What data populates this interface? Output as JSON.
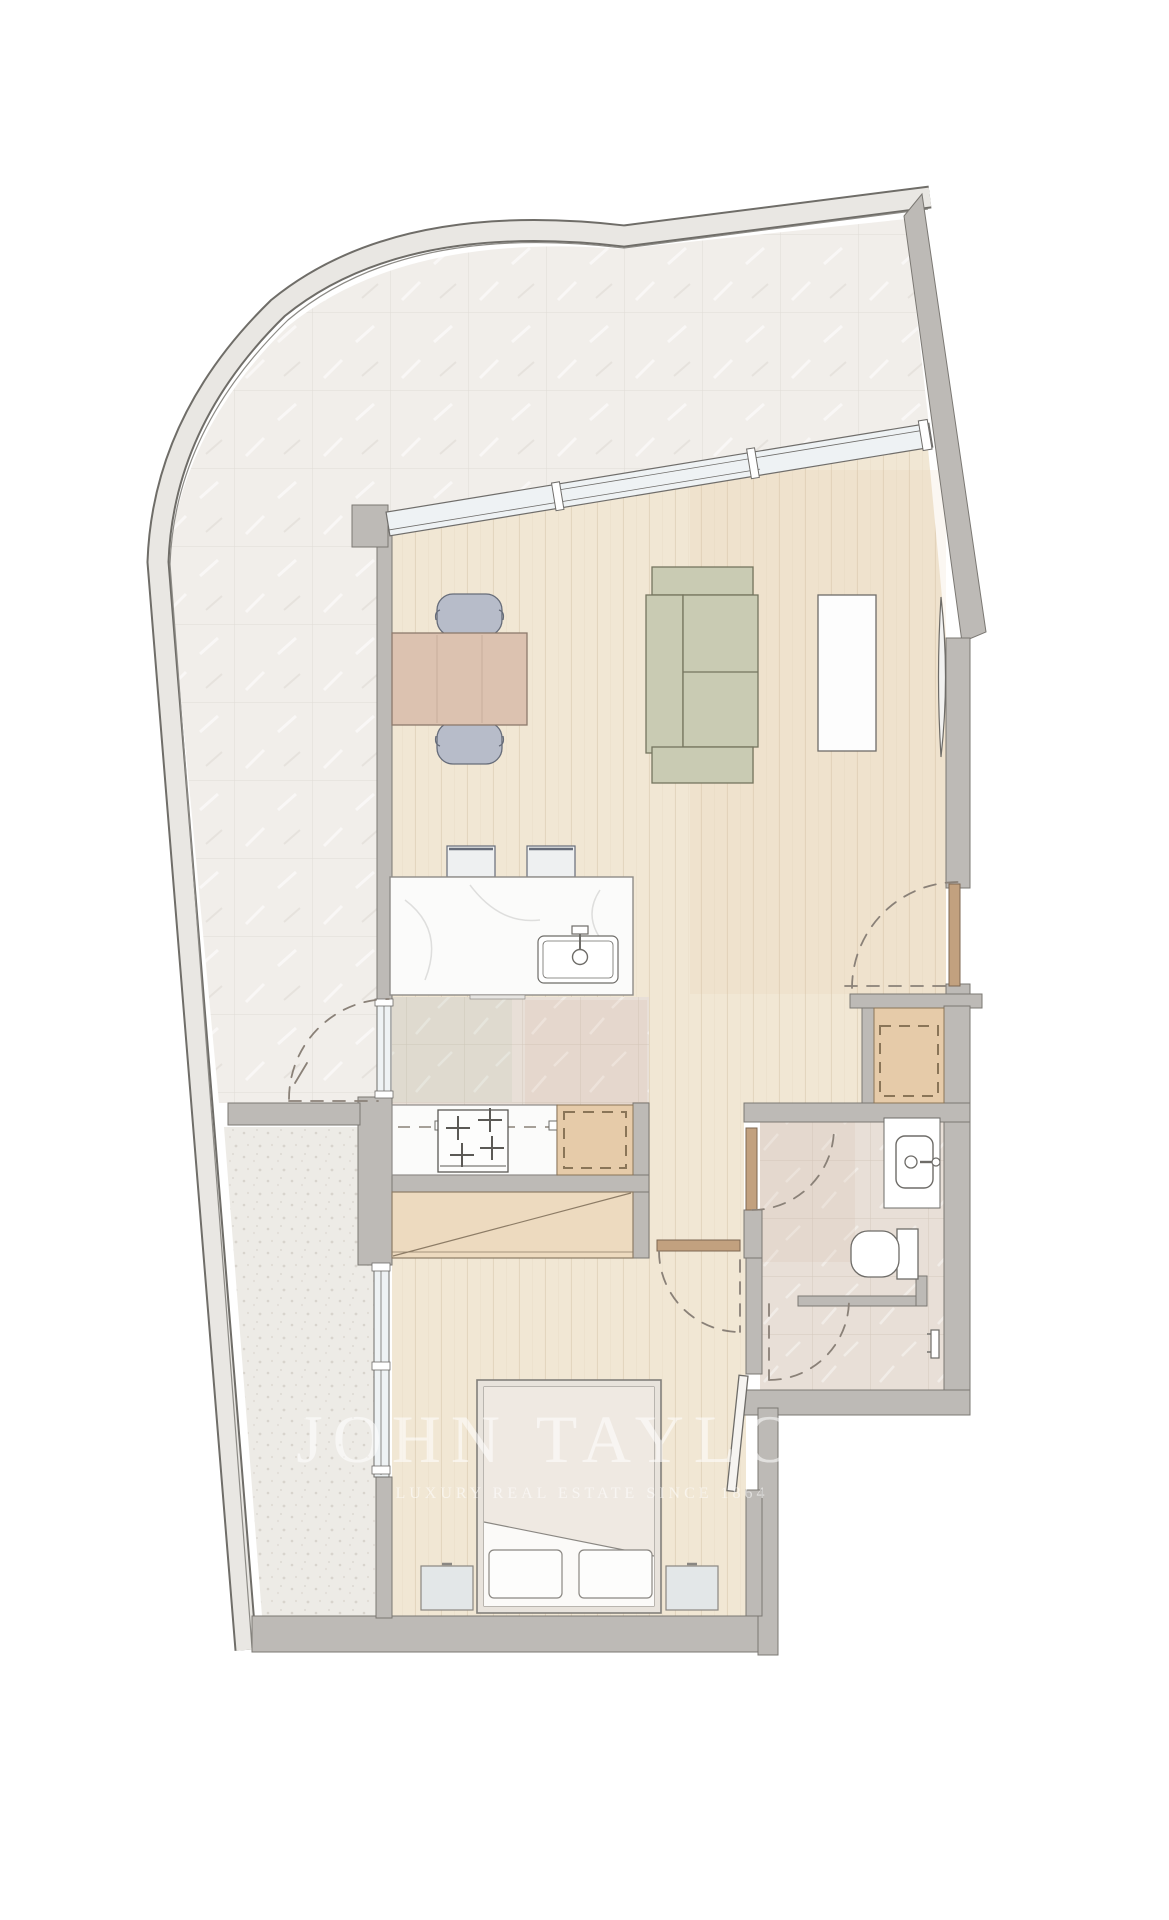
{
  "watermark": {
    "line1": "JOHN TAYLOR",
    "line2": "LUXURY REAL ESTATE SINCE 1864"
  },
  "colors": {
    "wood": "#f1e7d4",
    "woodLine": "#e3d6bf",
    "terr": "#f1eeea",
    "terrLine": "#e0dcd6",
    "gravel": "#edebe6",
    "gravelDot": "#d8d4cd",
    "stone": "#e8dfd7",
    "stoneLine": "#d4c9be",
    "wall": "#bdbab6",
    "wallStroke": "#7b7873",
    "outer": "#e9e7e3",
    "outerStroke": "#6f6d68",
    "glass": "#eef2f4",
    "glassStroke": "#6f6d6a",
    "doorLeaf": "#c2a17f",
    "doorLeafStroke": "#7d6752",
    "dash": "#8a8178",
    "sofa": "#c9cbb3",
    "sofaStroke": "#75755f",
    "tableWood": "#dcc2b0",
    "tableStroke": "#8d7a6c",
    "chair": "#b7bcc9",
    "chairStroke": "#666c79",
    "counter": "#fbfbfa",
    "counterStroke": "#8f8c88",
    "tan": "#e6cba9",
    "tanDash": "#8a7558",
    "closet": "#eddabf",
    "closetStroke": "#8d7c66",
    "bed": "#f0eae3",
    "sheet": "#fbfaf8",
    "pillow": "#fdfdfc",
    "nightstand": "#e3e7e8",
    "fixture": "#ffffff",
    "fixtureStroke": "#6e6c68",
    "wm": "rgba(255,255,255,0.55)"
  },
  "plan": {
    "type": "floor-plan",
    "furniture": [
      "dining-table",
      "dining-chair",
      "sofa",
      "tv-console",
      "tv",
      "kitchen-island",
      "bar-stool",
      "island-sink",
      "cooktop",
      "appliance-cabinet",
      "hall-cupboard",
      "wardrobe-closet",
      "double-bed",
      "pillow",
      "nightstand"
    ],
    "fixtures": [
      "entry-door",
      "terrace-door",
      "bathroom-door",
      "bedroom-door",
      "balcony-door",
      "shower-door",
      "washbasin",
      "toilet",
      "shower-mixer",
      "window-band"
    ]
  }
}
